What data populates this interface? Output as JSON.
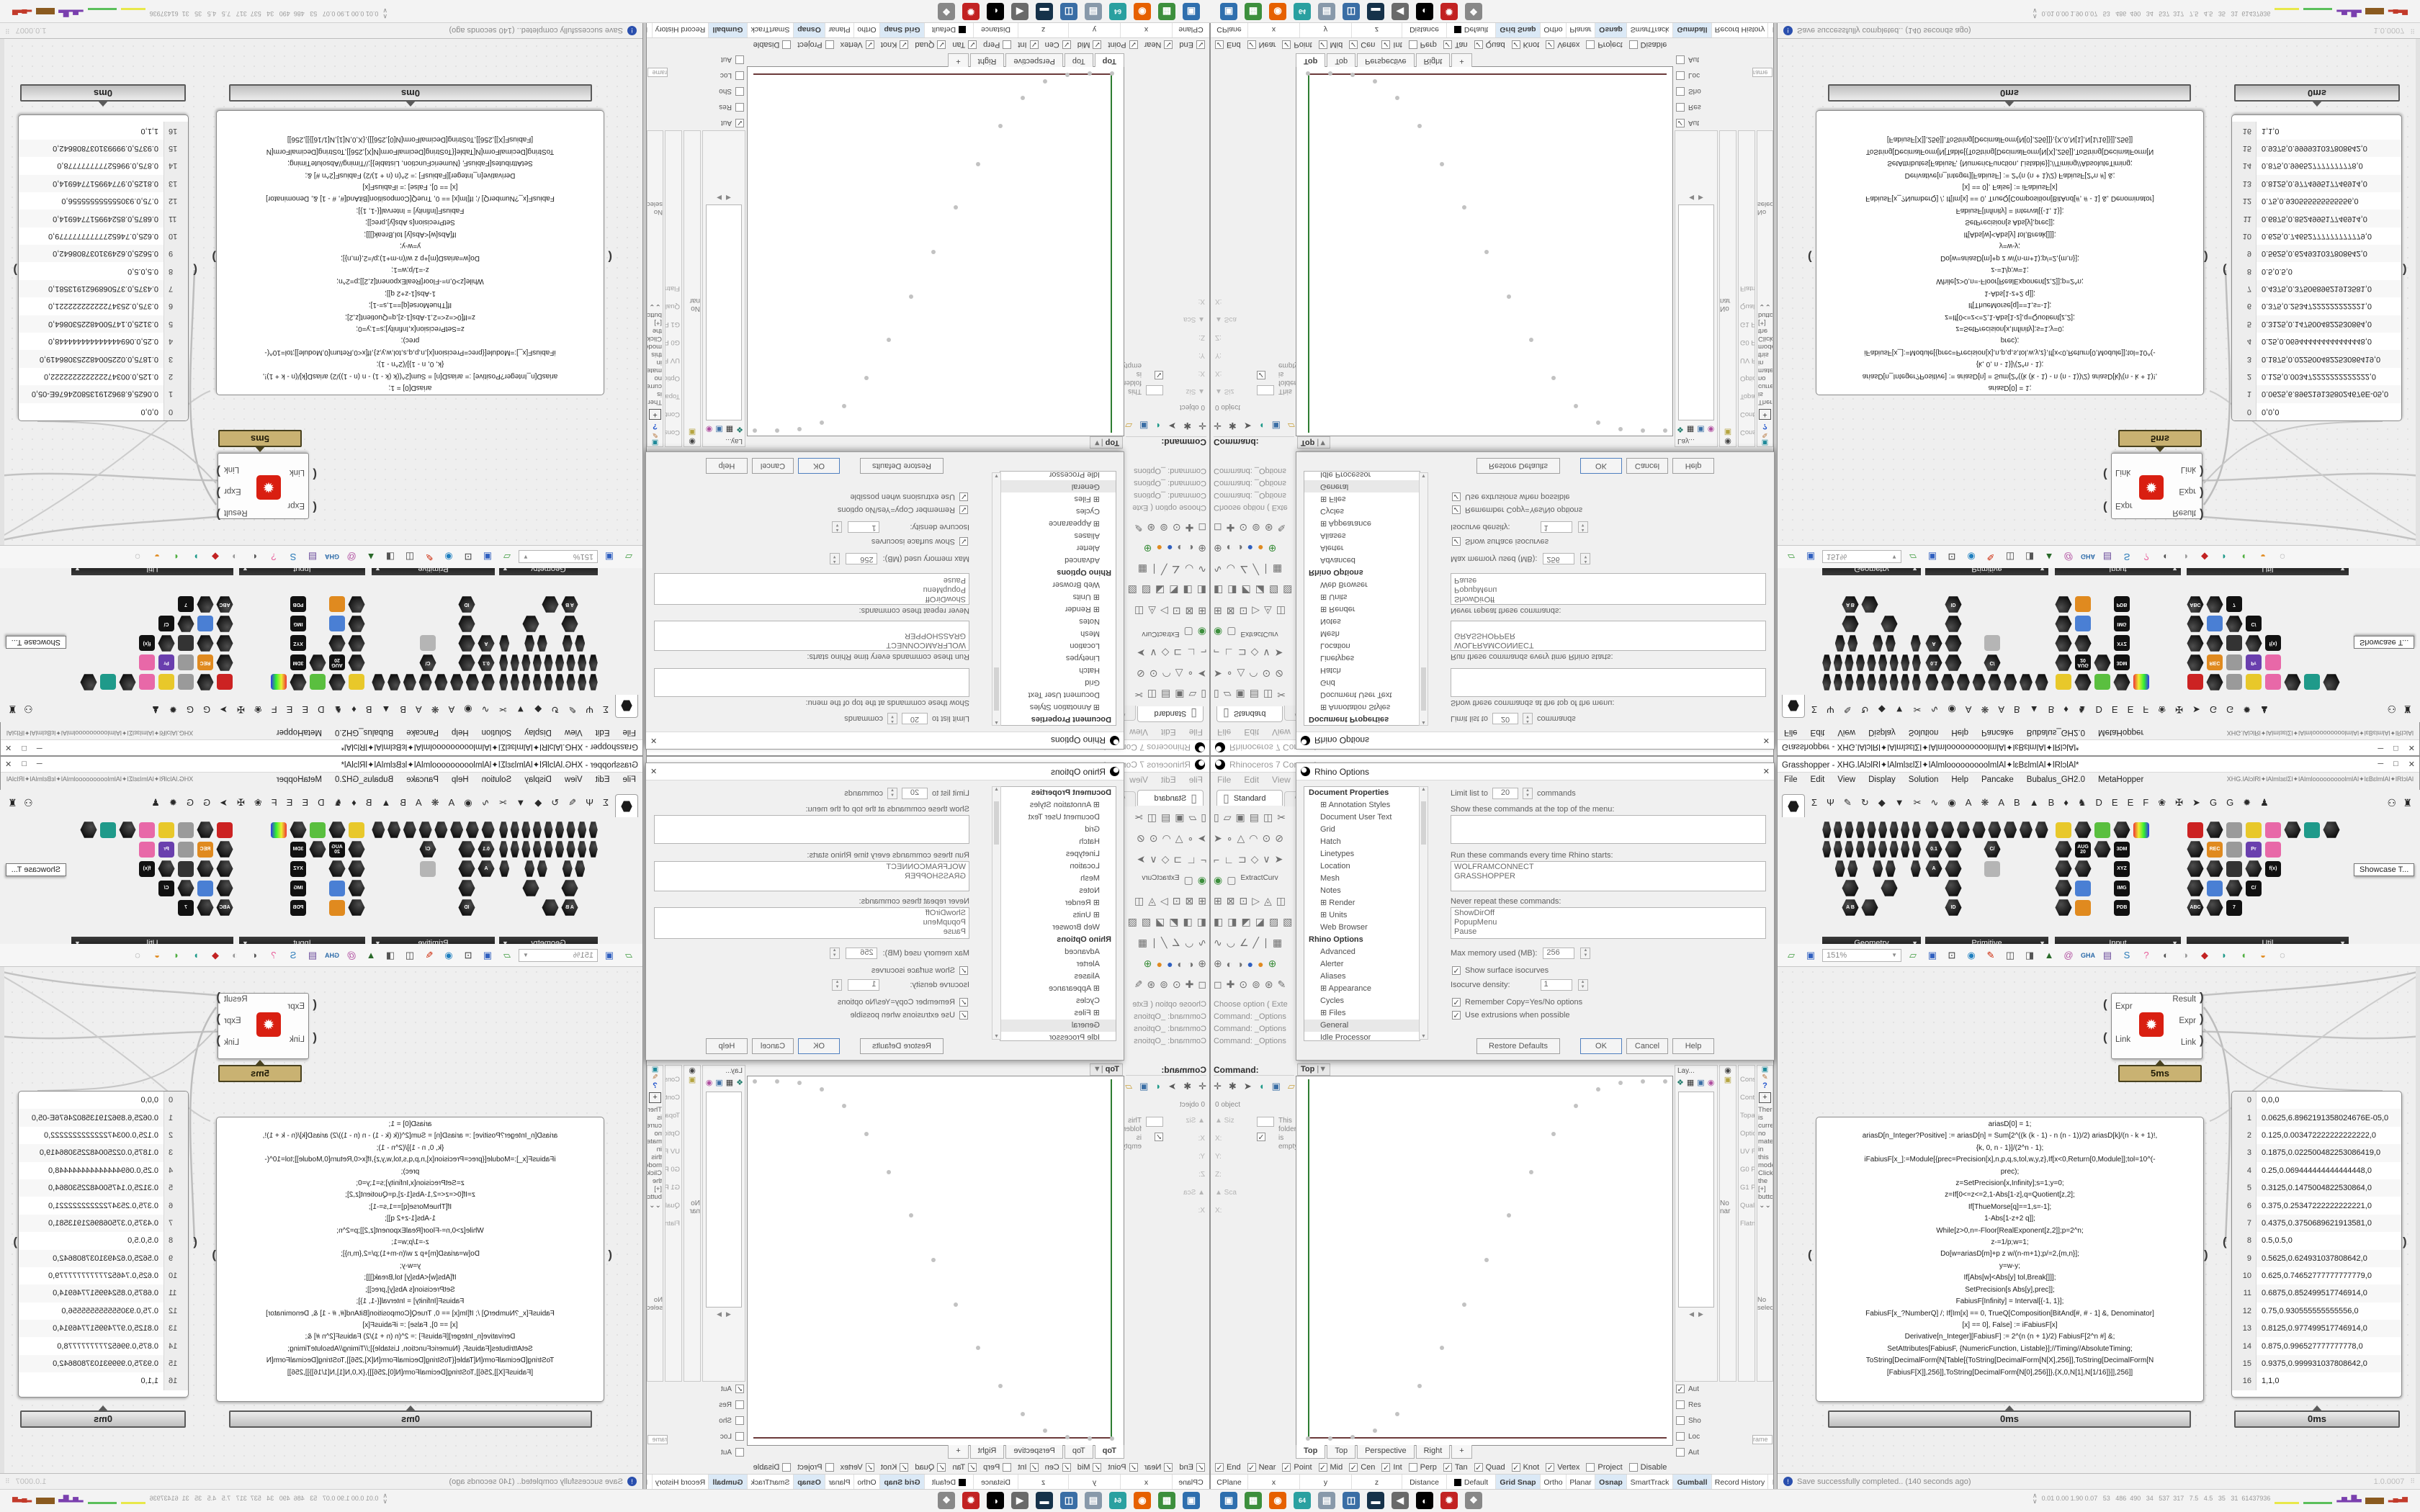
{
  "rhino": {
    "title": "Rhinoceros 7 Corporate -",
    "menu": [
      "File",
      "Edit",
      "View",
      "Curve"
    ],
    "standard_tab": "Standard",
    "toolbar_rows": [
      [
        {
          "n": "new-file-icon",
          "g": "▯"
        },
        {
          "n": "open-file-icon",
          "g": "▱"
        },
        {
          "n": "save-file-icon",
          "g": "▣"
        },
        {
          "n": "print-icon",
          "g": "▤"
        },
        {
          "n": "copy-icon",
          "g": "◫"
        },
        {
          "n": "cut-icon",
          "g": "✂"
        }
      ],
      [
        {
          "n": "select-arrow-icon",
          "g": "➤"
        },
        {
          "n": "point-icon",
          "g": "∘"
        },
        {
          "n": "polyline-icon",
          "g": "△"
        },
        {
          "n": "arc-icon",
          "g": "◠"
        },
        {
          "n": "circle-icon",
          "g": "⊙"
        },
        {
          "n": "ellipse-icon",
          "g": "⊘"
        }
      ],
      [
        {
          "n": "rect-icon",
          "g": "⌐"
        },
        {
          "n": "corner-icon",
          "g": "∟"
        },
        {
          "n": "curve-tool-icon",
          "g": "⊐"
        },
        {
          "n": "diamond-icon",
          "g": "◇"
        },
        {
          "n": "vee-icon",
          "g": "∨"
        },
        {
          "n": "snap-icon",
          "g": "➤"
        }
      ],
      [
        {
          "n": "web-globe-icon",
          "g": "◉"
        },
        {
          "n": "cylinder-icon",
          "g": "▢"
        }
      ],
      [
        {
          "n": "move-icon",
          "g": "⊞"
        },
        {
          "n": "rotate-icon",
          "g": "⊠"
        },
        {
          "n": "scale-icon",
          "g": "⊡"
        },
        {
          "n": "mirror-icon",
          "g": "▷"
        },
        {
          "n": "array-icon",
          "g": "◬"
        },
        {
          "n": "orient-icon",
          "g": "◫"
        }
      ],
      [
        {
          "n": "surface-icon",
          "g": "◧"
        },
        {
          "n": "loft-icon",
          "g": "◨"
        },
        {
          "n": "sweep-icon",
          "g": "◩"
        },
        {
          "n": "revolve-icon",
          "g": "◪"
        },
        {
          "n": "patch-icon",
          "g": "▨"
        },
        {
          "n": "drape-icon",
          "g": "▧"
        }
      ],
      [
        {
          "n": "dim-icon",
          "g": "∿"
        },
        {
          "n": "leader-icon",
          "g": "◡"
        },
        {
          "n": "angle-icon",
          "g": "∠"
        },
        {
          "n": "line-icon",
          "g": "╱"
        },
        {
          "n": "text-icon",
          "g": "∣"
        },
        {
          "n": "hatch-icon",
          "g": "▦"
        }
      ],
      [
        {
          "n": "sphere-wire-icon",
          "g": "⊕"
        },
        {
          "n": "sphere-grey-icon",
          "g": "◐"
        },
        {
          "n": "sphere-dark-icon",
          "g": "◑"
        },
        {
          "n": "sphere-blue-icon",
          "g": "●"
        },
        {
          "n": "sphere-orange-icon",
          "g": "●"
        },
        {
          "n": "globe-icon",
          "g": "⊕"
        }
      ],
      [
        {
          "n": "pan-icon",
          "g": "◻"
        },
        {
          "n": "gumball-icon",
          "g": "✚"
        },
        {
          "n": "zoom-icon",
          "g": "⊙"
        },
        {
          "n": "zoom-win-icon",
          "g": "⊚"
        },
        {
          "n": "zoom-sel-icon",
          "g": "⊛"
        },
        {
          "n": "annotate-icon",
          "g": "✎"
        }
      ]
    ],
    "extract_curve_label": "ExtractCurv",
    "command_history": [
      "Choose option ( Exte",
      "Command: _Options",
      "Command: _Options",
      "Command: _Options"
    ],
    "command_prompt": "Command:",
    "left_panel": {
      "objects_label": "0 object",
      "fields": [
        "Siz",
        "X:",
        "Y:",
        "Z:",
        "Sca",
        "X:"
      ],
      "folder_empty_text": "This folder is empty."
    },
    "options_dialog": {
      "title": "Rhino Options",
      "doc_header": "Document Properties",
      "doc_items": [
        {
          "label": "Annotation Styles",
          "expand": true
        },
        {
          "label": "Document User Text",
          "expand": false
        },
        {
          "label": "Grid",
          "expand": false
        },
        {
          "label": "Hatch",
          "expand": false
        },
        {
          "label": "Linetypes",
          "expand": false
        },
        {
          "label": "Location",
          "expand": false
        },
        {
          "label": "Mesh",
          "expand": false
        },
        {
          "label": "Notes",
          "expand": false
        },
        {
          "label": "Render",
          "expand": true
        },
        {
          "label": "Units",
          "expand": true
        },
        {
          "label": "Web Browser",
          "expand": false
        }
      ],
      "rhino_header": "Rhino Options",
      "rhino_items": [
        {
          "label": "Advanced",
          "expand": false
        },
        {
          "label": "Alerter",
          "expand": false
        },
        {
          "label": "Aliases",
          "expand": false
        },
        {
          "label": "Appearance",
          "expand": true
        },
        {
          "label": "Cycles",
          "expand": false
        },
        {
          "label": "Files",
          "expand": true
        },
        {
          "label": "General",
          "expand": false,
          "selected": true
        },
        {
          "label": "Idle Processor",
          "expand": false
        },
        {
          "label": "Keyboard",
          "expand": false
        },
        {
          "label": "Libraries",
          "expand": false
        },
        {
          "label": "Licenses",
          "expand": false
        },
        {
          "label": "Modeling Aids",
          "expand": true
        },
        {
          "label": "Mouse",
          "expand": true
        },
        {
          "label": "Plug-ins",
          "expand": false
        },
        {
          "label": "RhinoScript",
          "expand": false
        },
        {
          "label": "Selection Menu",
          "expand": false
        },
        {
          "label": "Toolbars",
          "expand": true
        }
      ],
      "limit_pre": "Limit list to",
      "limit_value": "20",
      "limit_post": "commands",
      "show_commands_label": "Show these commands at the top of the menu:",
      "run_commands_label": "Run these commands every time Rhino starts:",
      "run_commands_value": "WOLFRAMCONNECT\nGRASSHOPPER",
      "never_repeat_label": "Never repeat these commands:",
      "never_repeat_value": "ShowDirOff\nPopupMenu\nPause",
      "max_memory_label": "Max memory used (MB):",
      "max_memory_value": "256",
      "isocurves_label": "Show surface isocurves",
      "isocurve_density_label": "Isocurve density:",
      "isocurve_density_value": "1",
      "remember_label": "Remember Copy=Yes/No options",
      "extrusions_label": "Use extrusions when possible",
      "restore_button": "Restore Defaults",
      "ok_button": "OK",
      "cancel_button": "Cancel",
      "help_button": "Help"
    },
    "viewport": {
      "label": "Top",
      "tabs": [
        "Top",
        "Top",
        "Perspective",
        "Right"
      ],
      "axis_y_color": "#2e7d32",
      "axis_x_color": "#6b3a3a"
    },
    "osnap": [
      {
        "label": "End",
        "checked": true
      },
      {
        "label": "Near",
        "checked": true
      },
      {
        "label": "Point",
        "checked": true
      },
      {
        "label": "Mid",
        "checked": true
      },
      {
        "label": "Cen",
        "checked": true
      },
      {
        "label": "Int",
        "checked": true
      },
      {
        "label": "Perp",
        "checked": false
      },
      {
        "label": "Tan",
        "checked": true
      },
      {
        "label": "Quad",
        "checked": true
      },
      {
        "label": "Knot",
        "checked": true
      },
      {
        "label": "Vertex",
        "checked": true
      },
      {
        "label": "Project",
        "checked": false
      },
      {
        "label": "Disable",
        "checked": false
      }
    ],
    "status_cells": [
      {
        "label": "CPlane",
        "w": 52
      },
      {
        "label": "x",
        "w": 72
      },
      {
        "label": "y",
        "w": 72
      },
      {
        "label": "z",
        "w": 70
      },
      {
        "label": "Distance",
        "w": 62
      },
      {
        "label": "Default",
        "w": 68,
        "swatch": true
      },
      {
        "label": "Grid Snap",
        "w": 62,
        "on": true
      },
      {
        "label": "Ortho",
        "w": 36
      },
      {
        "label": "Planar",
        "w": 40
      },
      {
        "label": "Osnap",
        "w": 44,
        "on": true
      },
      {
        "label": "SmartTrack",
        "w": 64
      },
      {
        "label": "Gumball",
        "w": 54,
        "on": true
      },
      {
        "label": "Record History",
        "w": 78
      },
      {
        "label": "Filter",
        "w": 36
      }
    ],
    "dock": {
      "layers_tab": "Lay...",
      "col_f_items": [
        "Constra",
        "Contin",
        "Topak",
        "Options:",
        "UV Fl",
        "G0 Pr",
        "G1 Pr",
        "Qualit",
        "Flatne"
      ],
      "material_text": "There is currently no material in this model. Click the [+] button",
      "no_selection": "No selection",
      "no_name": "No nar",
      "checks": [
        {
          "label": "Aut",
          "checked": true
        },
        {
          "label": "Res",
          "checked": false
        },
        {
          "label": "Sho",
          "checked": false
        },
        {
          "label": "Loc",
          "checked": false
        },
        {
          "label": "Aut",
          "checked": false
        }
      ],
      "frame_label": "rame"
    }
  },
  "grasshopper": {
    "title": "Grasshopper - XHG.lAlɔlRl✦lAlmlɜɛlƩl✦lAlmlooooooooolmlAl✦lɛBɛlmlAl✦lRlɔlAl*",
    "menu": [
      "File",
      "Edit",
      "View",
      "Display",
      "Solution",
      "Help",
      "Pancake",
      "Bubalus_GH2.0",
      "MetaHopper"
    ],
    "menu_right": "XHG.lAlɔlRl✦lAlmlɜɛlƩl✦lAlmlooooooooolmlAl✦lɛBɛlmlAl✦lRlɔlAl",
    "category_tabs": [
      "Σ",
      "Ψ",
      "✎",
      "↻",
      "◆",
      "▼",
      "✂",
      "∿",
      "◉",
      "A",
      "❋",
      "A",
      "B",
      "▲",
      "B",
      "♦",
      "♞",
      "D",
      "E",
      "E",
      "F",
      "❀",
      "✠",
      "➤",
      "G",
      "G",
      "✹",
      "♟"
    ],
    "palette_groups": [
      {
        "name": "Geometry",
        "rows": [
          [
            "x",
            "x",
            "x",
            "x",
            "x",
            "x",
            "x",
            "x",
            "x"
          ],
          [
            "x",
            "x",
            "x",
            "x",
            "x",
            "x",
            "x",
            "x",
            "x"
          ],
          [
            "",
            "x",
            "x",
            "",
            "x",
            "x",
            "",
            "x"
          ],
          [
            "",
            "x",
            "",
            "x"
          ],
          [
            "",
            "x:A B",
            "x"
          ]
        ]
      },
      {
        "name": "Primitive",
        "rows": [
          [
            "x",
            "x",
            "x",
            "x",
            "x",
            "x",
            "x",
            "x"
          ],
          [
            "x:0.1",
            "x",
            "",
            "x:C/"
          ],
          [
            "x:A",
            "x",
            "",
            "s"
          ],
          [
            "",
            "x"
          ],
          [
            "",
            "x:ID"
          ]
        ]
      },
      {
        "name": "Input",
        "rows": [
          [
            "y",
            "x",
            "g",
            "x",
            "w"
          ],
          [
            "x",
            "c:AUG 20",
            "x",
            "c:3DM"
          ],
          [
            "x",
            "x",
            "",
            "c:XYZ"
          ],
          [
            "x",
            "b",
            "",
            "c:IMG"
          ],
          [
            "x",
            "o",
            "",
            "c:PDB"
          ]
        ]
      },
      {
        "name": "Util",
        "rows": [
          [
            "r",
            "x",
            "a",
            "y",
            "p",
            "x",
            "t",
            "x"
          ],
          [
            "x",
            "o:REC",
            "a",
            "u:Pr",
            "p"
          ],
          [
            "x",
            "x",
            "q",
            "x",
            "c:f(x)"
          ],
          [
            "x",
            "b",
            "x",
            "c:C/"
          ],
          [
            "x:ABC",
            "x",
            "c:7"
          ]
        ]
      }
    ],
    "showcase_tooltip": "Showcase T...",
    "toolbar": {
      "zoom_value": "151%",
      "icons": [
        {
          "n": "open-document-icon",
          "g": "▱",
          "c": "#3f9b3f"
        },
        {
          "n": "save-document-icon",
          "g": "▣",
          "c": "#2f5fbf"
        },
        {
          "n": "zoom-extents-icon",
          "g": "⊡",
          "c": "#333333"
        },
        {
          "n": "preview-eye-icon",
          "g": "◉",
          "c": "#1f7fbf"
        },
        {
          "n": "paint-flame-icon",
          "g": "✎",
          "c": "#cc2200"
        },
        {
          "n": "cluster-icon",
          "g": "◫",
          "c": "#444444"
        },
        {
          "n": "speaker-icon",
          "g": "◨",
          "c": "#555555"
        },
        {
          "n": "upload-tree-icon",
          "g": "▲",
          "c": "#2a6a2a"
        },
        {
          "n": "internet-globe-icon",
          "g": "@",
          "c": "#b04fa0"
        },
        {
          "n": "gha-chip-icon",
          "g": "GHA",
          "c": "#2b6aa8"
        },
        {
          "n": "notebook-icon",
          "g": "▤",
          "c": "#6a4a9a"
        },
        {
          "n": "search-s-icon",
          "g": "S",
          "c": "#2a7ab8"
        },
        {
          "n": "pink-box-icon",
          "g": "?",
          "c": "#e85f9a"
        },
        {
          "n": "mask-grey-icon",
          "g": "◐",
          "c": "#555555"
        },
        {
          "n": "mask-white-icon",
          "g": "◑",
          "c": "#9a9a9a"
        },
        {
          "n": "gem-red-icon",
          "g": "◆",
          "c": "#c22222"
        },
        {
          "n": "leaf-teal-icon",
          "g": "◗",
          "c": "#1f9a8a"
        },
        {
          "n": "leaf-green-icon",
          "g": "◖",
          "c": "#4fae3f"
        },
        {
          "n": "egg-orange-icon",
          "g": "◒",
          "c": "#e08a1f"
        },
        {
          "n": "selection-circle-icon",
          "g": "◌",
          "c": "#777777"
        }
      ]
    },
    "component": {
      "inputs": [
        "Expr",
        "Link"
      ],
      "outputs": [
        "Result",
        "Expr",
        "Link"
      ],
      "time_balloon": "5ms"
    },
    "code_panel": {
      "time_balloon": "0ms",
      "lines": [
        "ariasD[0] = 1;",
        "ariasD[n_Integer?Positive] := ariasD[n] = Sum[2^((k (k - 1) - n (n - 1))/2) ariasD[k]/(n - k + 1)!,",
        "{k, 0, n - 1}]/(2^n - 1);",
        "iFabiusF[x_]:=Module[{prec=Precision[x],n,p,q,s,tol,w,y,z},If[x<0,Return[0,Module]];tol=10^(-",
        "prec);",
        "z=SetPrecision[x,Infinity];s=1;y=0;",
        "z=If[0<=z<=2,1-Abs[1-z],q=Quotient[z,2];",
        "If[ThueMorse[q]==1,s=-1];",
        "1-Abs[1-z+2 q]];",
        "While[z>0,n=-Floor[RealExponent[z,2]];p=2^n;",
        "z-=1/p;w=1;",
        "Do[w=ariasD[m]+p z w/(n-m+1);p/=2,{m,n}];",
        "y=w-y;",
        "If[Abs[w]<Abs[y] tol,Break[]]];",
        "SetPrecision[s Abs[y],prec]];",
        "FabiusF[Infinity] = Interval[{-1, 1}];",
        "FabiusF[x_?NumberQ] /; If[Im[x] == 0, TrueQ[Composition[BitAnd[#, # - 1] &, Denominator]",
        "[x] == 0], False] := iFabiusF[x]",
        "Derivative[n_Integer][FabiusF] := 2^(n (n + 1)/2) FabiusF[2^n #] &;",
        "SetAttributes[FabiusF, {NumericFunction, Listable}];//Timing//AbsoluteTiming;",
        "",
        "ToString[DecimalForm[N[Table[{ToString[DecimalForm[N[X],256]],ToString[DecimalForm[N",
        "[FabiusF[X]],256]],ToString[DecimalForm[N[0],256]]},{X,0,N[1],N[1/16]}]],256]]"
      ]
    },
    "data_panel": {
      "time_balloon": "0ms",
      "rows": [
        "0,0,0",
        "0.0625,6.8962191358024676E-05,0",
        "0.125,0.003472222222222222,0",
        "0.1875,0.022500482253086419,0",
        "0.25,0.069444444444444448,0",
        "0.3125,0.1475004822530864,0",
        "0.375,0.25347222222222221,0",
        "0.4375,0.3750689621913581,0",
        "0.5,0.5,0",
        "0.5625,0.624931037808642,0",
        "0.625,0.74652777777777779,0",
        "0.6875,0.852499517746914,0",
        "0.75,0.930555555555556,0",
        "0.8125,0.977499517746914,0",
        "0.875,0.996527777777778,0",
        "0.9375,0.999931037808642,0",
        "1,1,0"
      ]
    },
    "status_text": "Save successfully completed.. (140 seconds ago)",
    "version_text": "1.0.0007"
  },
  "taskbar": {
    "icons": [
      {
        "n": "settings-monitor-icon",
        "g": "▣",
        "c": "#2f6fae"
      },
      {
        "n": "green-app-icon",
        "g": "▩",
        "c": "#3d8f3d"
      },
      {
        "n": "firefox-icon",
        "g": "◉",
        "c": "#e66000"
      },
      {
        "n": "save-64-icon",
        "g": "64",
        "c": "#2aa0a0"
      },
      {
        "n": "notepad-icon",
        "g": "▤",
        "c": "#8899aa"
      },
      {
        "n": "dual-monitor-icon",
        "g": "◫",
        "c": "#3a6ea5"
      },
      {
        "n": "console-icon",
        "g": "▬",
        "c": "#16324a"
      },
      {
        "n": "volume-icon",
        "g": "◀",
        "c": "#6a6a6a"
      },
      {
        "n": "rhino-app-icon",
        "g": "◐",
        "c": "#000000"
      },
      {
        "n": "scarab-red-icon",
        "g": "✹",
        "c": "#c22222"
      },
      {
        "n": "palette-icon",
        "g": "❖",
        "c": "#888888"
      }
    ],
    "monitor_text": "0.01 0.00 1.90 0.07   53   486  490   34   537  317   7.5   4.5   35   31  61437936"
  }
}
